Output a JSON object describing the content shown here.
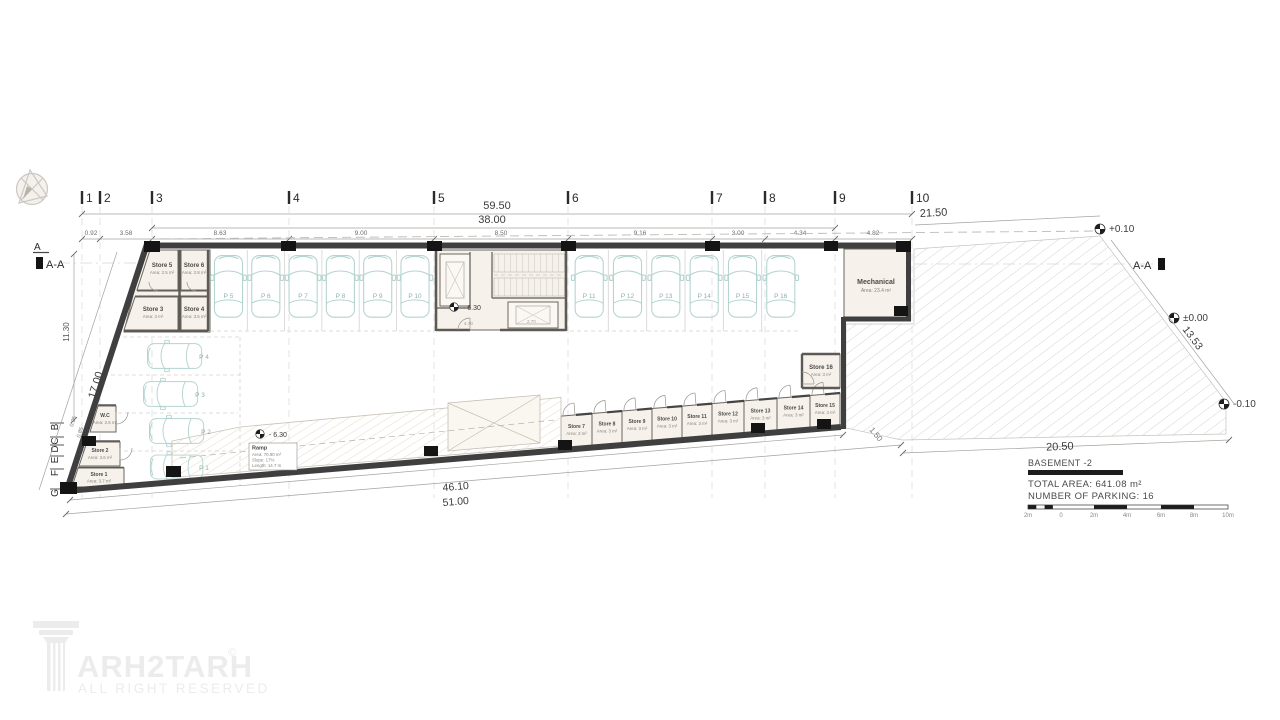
{
  "grid": {
    "cols": [
      "1",
      "2",
      "3",
      "4",
      "5",
      "6",
      "7",
      "8",
      "9",
      "10"
    ],
    "rows": [
      "A",
      "B",
      "C",
      "D",
      "E",
      "F",
      "G"
    ]
  },
  "dims": {
    "overall_top": "59.50",
    "building_top": "38.00",
    "yard_top": "21.50",
    "segs": [
      "0.92",
      "3.58",
      "8.63",
      "9.00",
      "8.50",
      "9.16",
      "3.00",
      "4.34",
      "4.82"
    ],
    "left_height": "11.30",
    "left_wall": "17.00",
    "lsegs": [
      "0.25",
      "0.85",
      "0.77",
      "0.82",
      "1.27"
    ],
    "bottom_inner": "46.10",
    "bottom_outer": "51.00",
    "right_wall": "13.53",
    "yard_bottom": "20.50",
    "step": "1.50",
    "stair_w": "4.70",
    "elev_w": "2.70"
  },
  "levels": {
    "street": "+0.10",
    "zero": "±0.00",
    "yard": "-0.10",
    "basement": "- 6.30"
  },
  "sections": {
    "aa": "A-A"
  },
  "parking": [
    "P 1",
    "P 2",
    "P 3",
    "P 4",
    "P 5",
    "P 6",
    "P 7",
    "P 8",
    "P 9",
    "P 10",
    "P 11",
    "P 12",
    "P 13",
    "P 14",
    "P 15",
    "P 16"
  ],
  "stores": [
    {
      "n": "Store 1",
      "a": "Area: 3.7 m²"
    },
    {
      "n": "Store 2",
      "a": "Area: 3.6 m²"
    },
    {
      "n": "Store 3",
      "a": "Area: 3 m²"
    },
    {
      "n": "Store 4",
      "a": "Area: 3.5 m²"
    },
    {
      "n": "Store 5",
      "a": "Area: 2.5 m²"
    },
    {
      "n": "Store 6",
      "a": "Area: 2.8 m²"
    },
    {
      "n": "Store 7",
      "a": "Area: 3 m²"
    },
    {
      "n": "Store 8",
      "a": "Area: 3 m²"
    },
    {
      "n": "Store 9",
      "a": "Area: 3 m²"
    },
    {
      "n": "Store 10",
      "a": "Area: 3 m²"
    },
    {
      "n": "Store 11",
      "a": "Area: 3 m²"
    },
    {
      "n": "Store 12",
      "a": "Area: 3 m²"
    },
    {
      "n": "Store 13",
      "a": "Area: 3 m²"
    },
    {
      "n": "Store 14",
      "a": "Area: 3 m²"
    },
    {
      "n": "Store 15",
      "a": "Area: 3 m²"
    },
    {
      "n": "Store 16",
      "a": "Area: 3 m²"
    }
  ],
  "wc": {
    "n": "W.C",
    "a": "Area: 2.6 m²"
  },
  "mech": {
    "n": "Mechanical",
    "a": "Area: 23.4 m²"
  },
  "ramp": {
    "n": "Ramp",
    "l1": "Area: 70.90 m²",
    "l2": "Slope: 17%",
    "l3": "Length: 14.7 m"
  },
  "title": {
    "floor": "BASEMENT -2",
    "area": "TOTAL AREA: 641.08 m²",
    "parking": "NUMBER OF PARKING: 16",
    "scale": [
      "2m",
      "0",
      "2m",
      "4m",
      "6m",
      "8m",
      "10m"
    ]
  },
  "logo": {
    "brand": "ARH2TARH",
    "c": "©",
    "tag": "ALL RIGHT RESERVED"
  }
}
